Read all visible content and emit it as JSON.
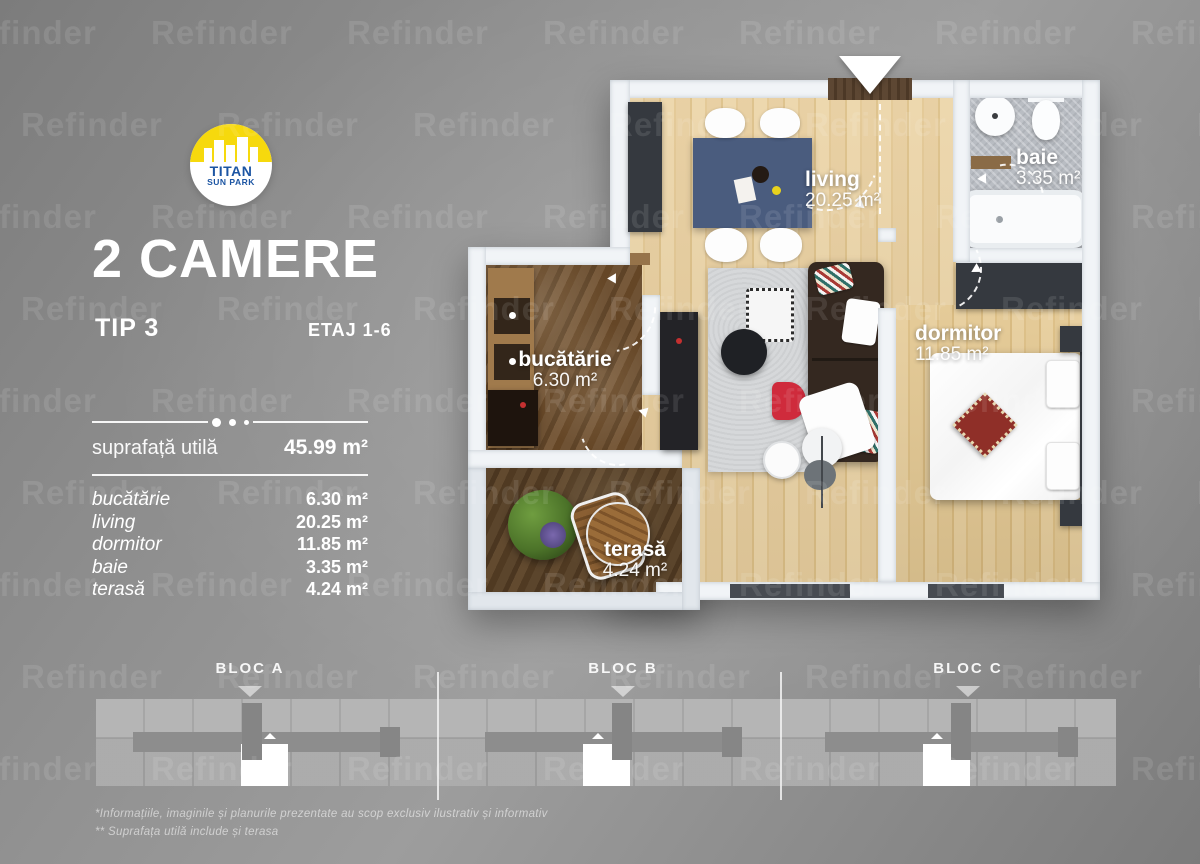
{
  "watermark": {
    "text": "Refinder"
  },
  "logo": {
    "name": "TITAN",
    "subname": "SUN PARK"
  },
  "header": {
    "title": "2 CAMERE",
    "type_label": "TIP 3",
    "floor_label": "ETAJ 1-6"
  },
  "summary": {
    "label": "suprafață utilă",
    "value": "45.99 m²"
  },
  "rooms": [
    {
      "name": "bucătărie",
      "area": "6.30 m²"
    },
    {
      "name": "living",
      "area": "20.25 m²"
    },
    {
      "name": "dormitor",
      "area": "11.85 m²"
    },
    {
      "name": "baie",
      "area": "3.35 m²"
    },
    {
      "name": "terasă",
      "area": "4.24 m²"
    }
  ],
  "blocs": [
    {
      "label": "BLOC A"
    },
    {
      "label": "BLOC B"
    },
    {
      "label": "BLOC C"
    }
  ],
  "footnotes": {
    "line1": "*Informațiile, imaginile și planurile prezentate au scop exclusiv ilustrativ și informativ",
    "line2": "** Suprafața utilă include și terasa"
  },
  "colors": {
    "logo_yellow": "#f6d90d",
    "logo_blue": "#1c55a3",
    "accent_red": "#cf2b3c",
    "wall_white": "#f1f4f7",
    "wood_floor": "#e7cd9d",
    "kitchen_floor": "#6b4e31",
    "terrace_floor": "#54402a",
    "bath_tile": "#b9bdc3",
    "furniture_dark": "#35393f",
    "couch_brown": "#342820",
    "table_navy": "#4a5c7e",
    "rug_gray": "#d6d8da"
  }
}
